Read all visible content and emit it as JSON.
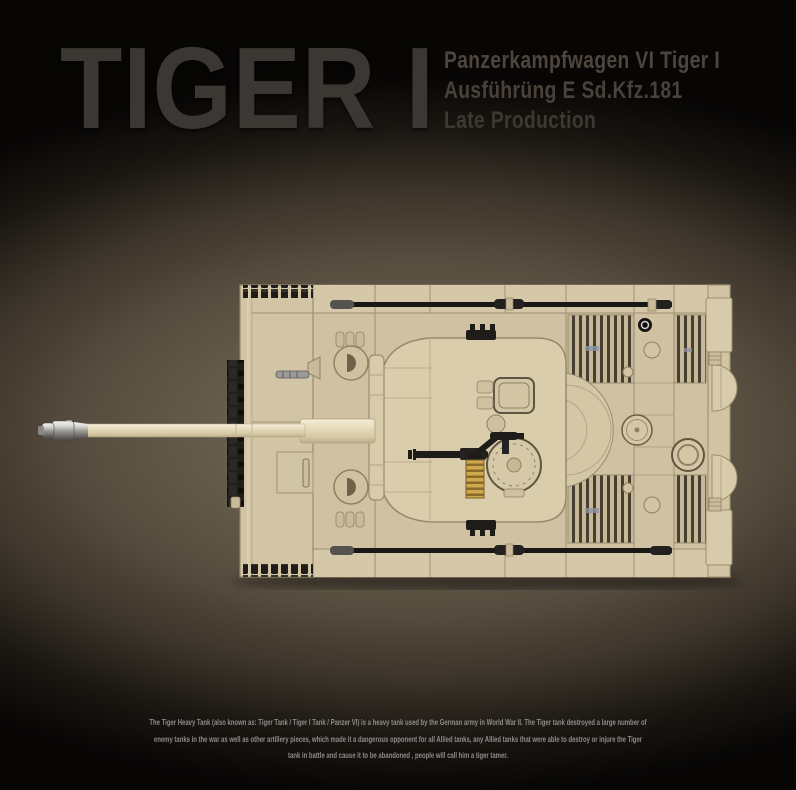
{
  "header": {
    "title": "TIGER I",
    "subtitle_lines": [
      "Panzerkampfwagen VI Tiger I",
      "Ausführüng E Sd.Kfz.181",
      "Late Production"
    ]
  },
  "illustration": {
    "alt": "Top view of a brick-built Tiger I tank model, long gun barrel pointing left"
  },
  "description": {
    "lines": [
      "The Tiger Heavy Tank (also known as: Tiger Tank / Tiger I Tank / Panzer VI) is a heavy tank used by the German army in World War II. The Tiger tank destroyed a large number of",
      "enemy tanks in the war as well as other artillery pieces, which made it a dangerous opponent for all Allied tanks, any Allied tanks that were able to destroy or injure the Tiger",
      "tank in battle and cause it to be abandoned , people will call him a tiger tamer."
    ]
  },
  "colors": {
    "background": "#070605",
    "glow_center": "#6f6455",
    "brick_tan": "#d3c6a6",
    "brick_shadow": "#b2a483",
    "panel_line": "#9a8c6e",
    "track_black": "#1d1c19",
    "barrel_cream": "#e9dec2",
    "muzzle_silver": "#c9c7c3",
    "spring_brass": "#c9a44c",
    "title_gray": "#3b3833",
    "subtitle_brown": "#4c443c",
    "description_gray": "#8f8d8a"
  }
}
